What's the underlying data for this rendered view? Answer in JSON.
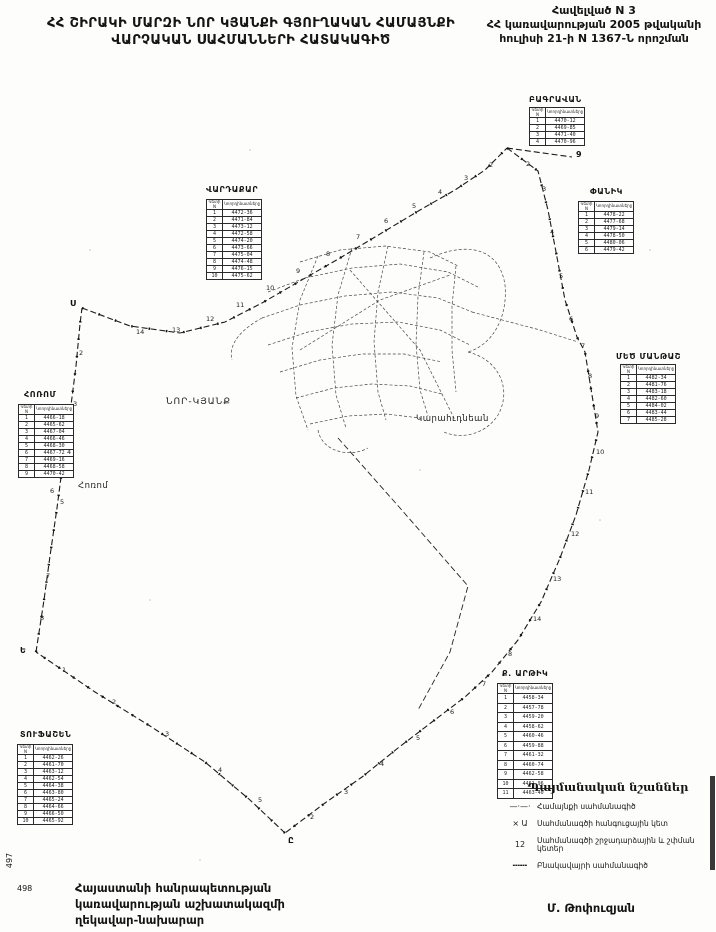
{
  "header": {
    "title_line1": "ՀՀ ՇԻՐԱԿԻ ՄԱՐԶԻ ՆՈՐ ԿՅԱՆՔԻ ԳՅՈՒՂԱԿԱՆ ՀԱՄԱՅՆՔԻ",
    "title_line2": "ՎԱՐՉԱԿԱՆ ՍԱՀՄԱՆՆԵՐԻ ՀԱՏԱԿԱԳԻԾ",
    "annex_line1": "Հավելված N 3",
    "annex_line2": "ՀՀ կառավարության 2005 թվականի",
    "annex_line3": "հուլիսի 21-ի N 1367-Ն որոշման"
  },
  "map": {
    "labels": [
      {
        "text": "ՆՈՐ-ԿՅԱՆՔ",
        "x": 166,
        "y": 397,
        "size": 9,
        "bold": false,
        "spacing": 1
      },
      {
        "text": "Կարահւդնեան",
        "x": 416,
        "y": 414,
        "size": 8.5,
        "bold": false,
        "spacing": 0.5
      },
      {
        "text": "Հոռոմ",
        "x": 78,
        "y": 481,
        "size": 8.5,
        "bold": false,
        "spacing": 0.5
      }
    ],
    "vertex_letters": [
      {
        "t": "Ս",
        "x": 70,
        "y": 299
      },
      {
        "t": "9",
        "x": 576,
        "y": 150
      },
      {
        "t": "Ե",
        "x": 20,
        "y": 646
      },
      {
        "t": "Ը",
        "x": 288,
        "y": 836
      }
    ],
    "point_numbers": [
      {
        "n": "2",
        "x": 489,
        "y": 161
      },
      {
        "n": "3",
        "x": 464,
        "y": 174
      },
      {
        "n": "4",
        "x": 438,
        "y": 188
      },
      {
        "n": "5",
        "x": 412,
        "y": 202
      },
      {
        "n": "6",
        "x": 384,
        "y": 217
      },
      {
        "n": "7",
        "x": 356,
        "y": 233
      },
      {
        "n": "8",
        "x": 326,
        "y": 250
      },
      {
        "n": "9",
        "x": 296,
        "y": 267
      },
      {
        "n": "10",
        "x": 266,
        "y": 284
      },
      {
        "n": "11",
        "x": 236,
        "y": 301
      },
      {
        "n": "12",
        "x": 206,
        "y": 315
      },
      {
        "n": "13",
        "x": 172,
        "y": 326
      },
      {
        "n": "14",
        "x": 136,
        "y": 328
      },
      {
        "n": "2",
        "x": 526,
        "y": 160
      },
      {
        "n": "3",
        "x": 542,
        "y": 185
      },
      {
        "n": "4",
        "x": 550,
        "y": 228
      },
      {
        "n": "5",
        "x": 559,
        "y": 272
      },
      {
        "n": "6",
        "x": 569,
        "y": 315
      },
      {
        "n": "7",
        "x": 581,
        "y": 342
      },
      {
        "n": "8",
        "x": 588,
        "y": 372
      },
      {
        "n": "9",
        "x": 595,
        "y": 412
      },
      {
        "n": "10",
        "x": 596,
        "y": 448
      },
      {
        "n": "11",
        "x": 585,
        "y": 488
      },
      {
        "n": "12",
        "x": 571,
        "y": 530
      },
      {
        "n": "13",
        "x": 553,
        "y": 575
      },
      {
        "n": "14",
        "x": 533,
        "y": 615
      },
      {
        "n": "8",
        "x": 508,
        "y": 650
      },
      {
        "n": "7",
        "x": 482,
        "y": 680
      },
      {
        "n": "6",
        "x": 450,
        "y": 708
      },
      {
        "n": "5",
        "x": 416,
        "y": 734
      },
      {
        "n": "4",
        "x": 380,
        "y": 760
      },
      {
        "n": "3",
        "x": 344,
        "y": 788
      },
      {
        "n": "2",
        "x": 310,
        "y": 813
      },
      {
        "n": "1",
        "x": 62,
        "y": 666
      },
      {
        "n": "2",
        "x": 112,
        "y": 698
      },
      {
        "n": "3",
        "x": 165,
        "y": 730
      },
      {
        "n": "4",
        "x": 218,
        "y": 766
      },
      {
        "n": "5",
        "x": 258,
        "y": 796
      },
      {
        "n": "2",
        "x": 79,
        "y": 349
      },
      {
        "n": "3",
        "x": 73,
        "y": 400
      },
      {
        "n": "4",
        "x": 67,
        "y": 448
      },
      {
        "n": "5",
        "x": 60,
        "y": 498
      },
      {
        "n": "6",
        "x": 50,
        "y": 487
      },
      {
        "n": "7",
        "x": 46,
        "y": 572
      },
      {
        "n": "8",
        "x": 40,
        "y": 614
      }
    ]
  },
  "tables": [
    {
      "id": "bagravan",
      "label": "ԲԱԳՐԱՎԱՆ",
      "label_x": 529,
      "label_y": 95,
      "x": 529,
      "y": 107,
      "rows": [
        [
          "1",
          "4470-12"
        ],
        [
          "2",
          "4469-85"
        ],
        [
          "3",
          "4471-40"
        ],
        [
          "4",
          "4470-96"
        ]
      ]
    },
    {
      "id": "vardakar",
      "label": "ՎԱՐԴԱՔԱՐ",
      "label_x": 206,
      "label_y": 185,
      "x": 206,
      "y": 199,
      "rows": [
        [
          "1",
          "4472-36"
        ],
        [
          "2",
          "4471-84"
        ],
        [
          "3",
          "4473-12"
        ],
        [
          "4",
          "4472-58"
        ],
        [
          "5",
          "4474-20"
        ],
        [
          "6",
          "4473-66"
        ],
        [
          "7",
          "4475-04"
        ],
        [
          "8",
          "4474-48"
        ],
        [
          "9",
          "4476-15"
        ],
        [
          "10",
          "4475-62"
        ]
      ]
    },
    {
      "id": "panik",
      "label": "ՓԱՆԻԿ",
      "label_x": 590,
      "label_y": 187,
      "x": 578,
      "y": 201,
      "rows": [
        [
          "1",
          "4478-22"
        ],
        [
          "2",
          "4477-68"
        ],
        [
          "3",
          "4479-14"
        ],
        [
          "4",
          "4478-50"
        ],
        [
          "5",
          "4480-06"
        ],
        [
          "6",
          "4479-42"
        ]
      ]
    },
    {
      "id": "mets-mantash",
      "label": "ՄԵԾ ՄԱՆԹԱՇ",
      "label_x": 616,
      "label_y": 352,
      "x": 620,
      "y": 364,
      "rows": [
        [
          "1",
          "4482-34"
        ],
        [
          "2",
          "4481-76"
        ],
        [
          "3",
          "4483-18"
        ],
        [
          "4",
          "4482-60"
        ],
        [
          "5",
          "4484-02"
        ],
        [
          "6",
          "4483-44"
        ],
        [
          "7",
          "4485-28"
        ]
      ]
    },
    {
      "id": "horom",
      "label": "ՀՈՌՈՄ",
      "label_x": 24,
      "label_y": 390,
      "x": 18,
      "y": 404,
      "rows": [
        [
          "1",
          "4466-18"
        ],
        [
          "2",
          "4465-62"
        ],
        [
          "3",
          "4467-04"
        ],
        [
          "4",
          "4466-46"
        ],
        [
          "5",
          "4468-30"
        ],
        [
          "6",
          "4467-72"
        ],
        [
          "7",
          "4469-16"
        ],
        [
          "8",
          "4468-58"
        ],
        [
          "9",
          "4470-42"
        ]
      ]
    },
    {
      "id": "tufashen",
      "label": "ՏՈՒՖԱՇԵՆ",
      "label_x": 20,
      "label_y": 730,
      "x": 17,
      "y": 744,
      "rows": [
        [
          "1",
          "4462-26"
        ],
        [
          "2",
          "4461-70"
        ],
        [
          "3",
          "4463-12"
        ],
        [
          "4",
          "4462-54"
        ],
        [
          "5",
          "4464-38"
        ],
        [
          "6",
          "4463-80"
        ],
        [
          "7",
          "4465-24"
        ],
        [
          "8",
          "4464-66"
        ],
        [
          "9",
          "4466-50"
        ],
        [
          "10",
          "4465-92"
        ]
      ]
    },
    {
      "id": "artik",
      "label": "Ք. ԱՐԹԻԿ",
      "label_x": 502,
      "label_y": 669,
      "x": 497,
      "y": 683,
      "rh": 9.5,
      "rows": [
        [
          "1",
          "4458-34"
        ],
        [
          "2",
          "4457-78"
        ],
        [
          "3",
          "4459-20"
        ],
        [
          "4",
          "4458-62"
        ],
        [
          "5",
          "4460-46"
        ],
        [
          "6",
          "4459-88"
        ],
        [
          "7",
          "4461-32"
        ],
        [
          "8",
          "4460-74"
        ],
        [
          "9",
          "4462-58"
        ],
        [
          "10",
          "4461-96"
        ],
        [
          "11",
          "4463-40"
        ]
      ]
    }
  ],
  "table_header": [
    "Կետի N",
    "Կոորդինատները"
  ],
  "legend": {
    "title": "Պայմանական նշաններ",
    "items": [
      {
        "symbol": "—·—·",
        "label": "Համայնքի սահմանագիծ"
      },
      {
        "symbol": "× Ա",
        "label": "Սահմանագծի հանգուցային կետ"
      },
      {
        "symbol": "12",
        "label": "Սահմանագծի շրջադարձային և շփման կետեր"
      },
      {
        "symbol": "╍╍╍",
        "label": "Բնակավայրի սահմանագիծ"
      }
    ]
  },
  "footer": {
    "line1": "Հայաստանի հանրապետության",
    "line2": "կառավարության աշխատակազմի",
    "line3": "ղեկավար-նախարար",
    "signature": "Մ. Թոփուզյան",
    "page_rotated": "497",
    "page": "498"
  },
  "colors": {
    "ink": "#141414",
    "paper": "#fdfdfb"
  }
}
